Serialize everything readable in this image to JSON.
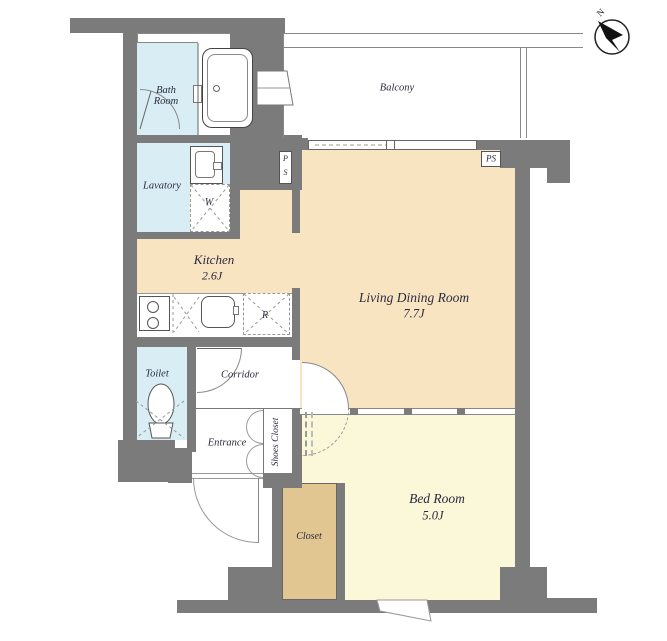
{
  "colors": {
    "wall": "#7b7b7b",
    "peach": "#f9e4c2",
    "yellow": "#fbf7d9",
    "tan": "#e2c691",
    "blue": "#d9edf4",
    "ink": "#2b2b3f"
  },
  "rooms": {
    "bath_room": {
      "line1": "Bath",
      "line2": "Room"
    },
    "lavatory": {
      "name": "Lavatory"
    },
    "kitchen": {
      "name": "Kitchen",
      "size": "2.6J"
    },
    "toilet": {
      "name": "Toilet"
    },
    "corridor": {
      "name": "Corridor"
    },
    "entrance": {
      "name": "Entrance"
    },
    "shoes_closet": {
      "name": "Shoes Closet"
    },
    "closet": {
      "name": "Closet"
    },
    "bed_room": {
      "name": "Bed Room",
      "size": "5.0J"
    },
    "living_dining": {
      "name": "Living Dining Room",
      "size": "7.7J"
    },
    "balcony": {
      "name": "Balcony"
    }
  },
  "fixtures": {
    "washing_machine": "W",
    "refrigerator": "R",
    "pipe_space_vertical": {
      "line1": "P",
      "line2": "S"
    },
    "pipe_space": "PS"
  },
  "compass": {
    "north": "N"
  }
}
